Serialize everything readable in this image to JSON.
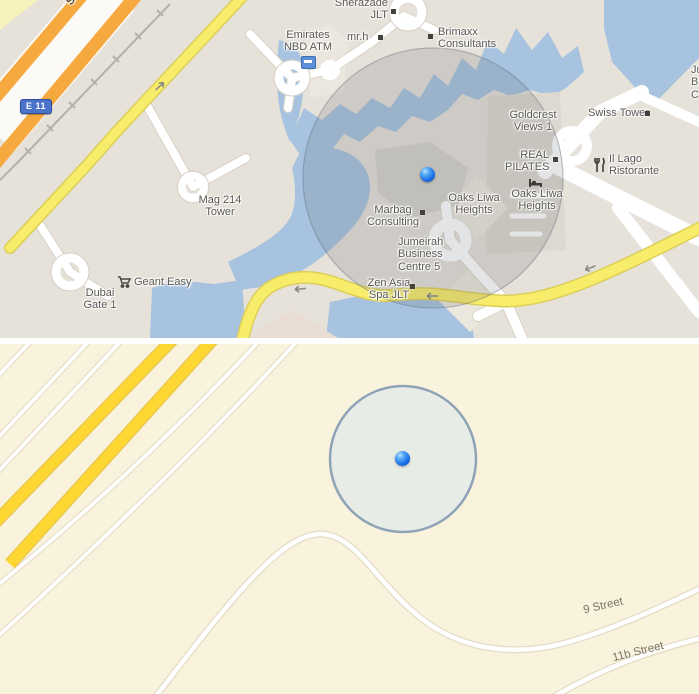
{
  "top_map": {
    "style": "google-maps-classic",
    "route_badge": "E 11",
    "road_labels": {
      "sheikh": "Sheikh"
    },
    "pois": {
      "sherazade": "Sherazade\nJLT",
      "emirates_nbd": "Emirates\nNBD ATM",
      "mr_h": "mr.h",
      "brimaxx": "Brimaxx\nConsultants",
      "goldcrest": "Goldcrest\nViews 1",
      "swiss_tower": "Swiss Tower",
      "real_pilates": "REAL\nPILATES",
      "il_lago": "Il Lago\nRistorante",
      "oaks_left": "Oaks Liwa\nHeights",
      "oaks_right": "Oaks Liwa\nHeights",
      "marbag": "Marbag\nConsulting",
      "jbc5": "Jumeirah\nBusiness\nCentre 5",
      "zen_asia": "Zen Asia\nSpa JLT",
      "mag214": "Mag 214\nTower",
      "geant": "Geant Easy",
      "dubai_gate": "Dubai\nGate 1",
      "edge_clipped": "Ju\nBu\nCe"
    },
    "icons": [
      "atm-icon",
      "restaurant-icon",
      "lodging-icon",
      "shopping-cart-icon"
    ],
    "location_indicator": "blue-dot-with-accuracy-circle"
  },
  "bottom_map": {
    "style": "apple-maps-classic",
    "street_labels": {
      "nine": "9 Street",
      "elevenb": "11b Street"
    },
    "location_indicator": "blue-dot-with-accuracy-circle"
  },
  "colors": {
    "water": "#a7c3df",
    "highway_orange": "#f6a93e",
    "road_yellow_top": "#f8ed6b",
    "road_yellow_bottom": "#ffd733",
    "land_top": "#e6e1d9",
    "land_bottom": "#f9f2dc",
    "accuracy_circle_fill_bottom": "#e7ebe6",
    "accuracy_circle_stroke": "#8fa3b6",
    "location_dot_blue": "#1a6fe8",
    "route_badge_blue": "#4a73c9"
  }
}
